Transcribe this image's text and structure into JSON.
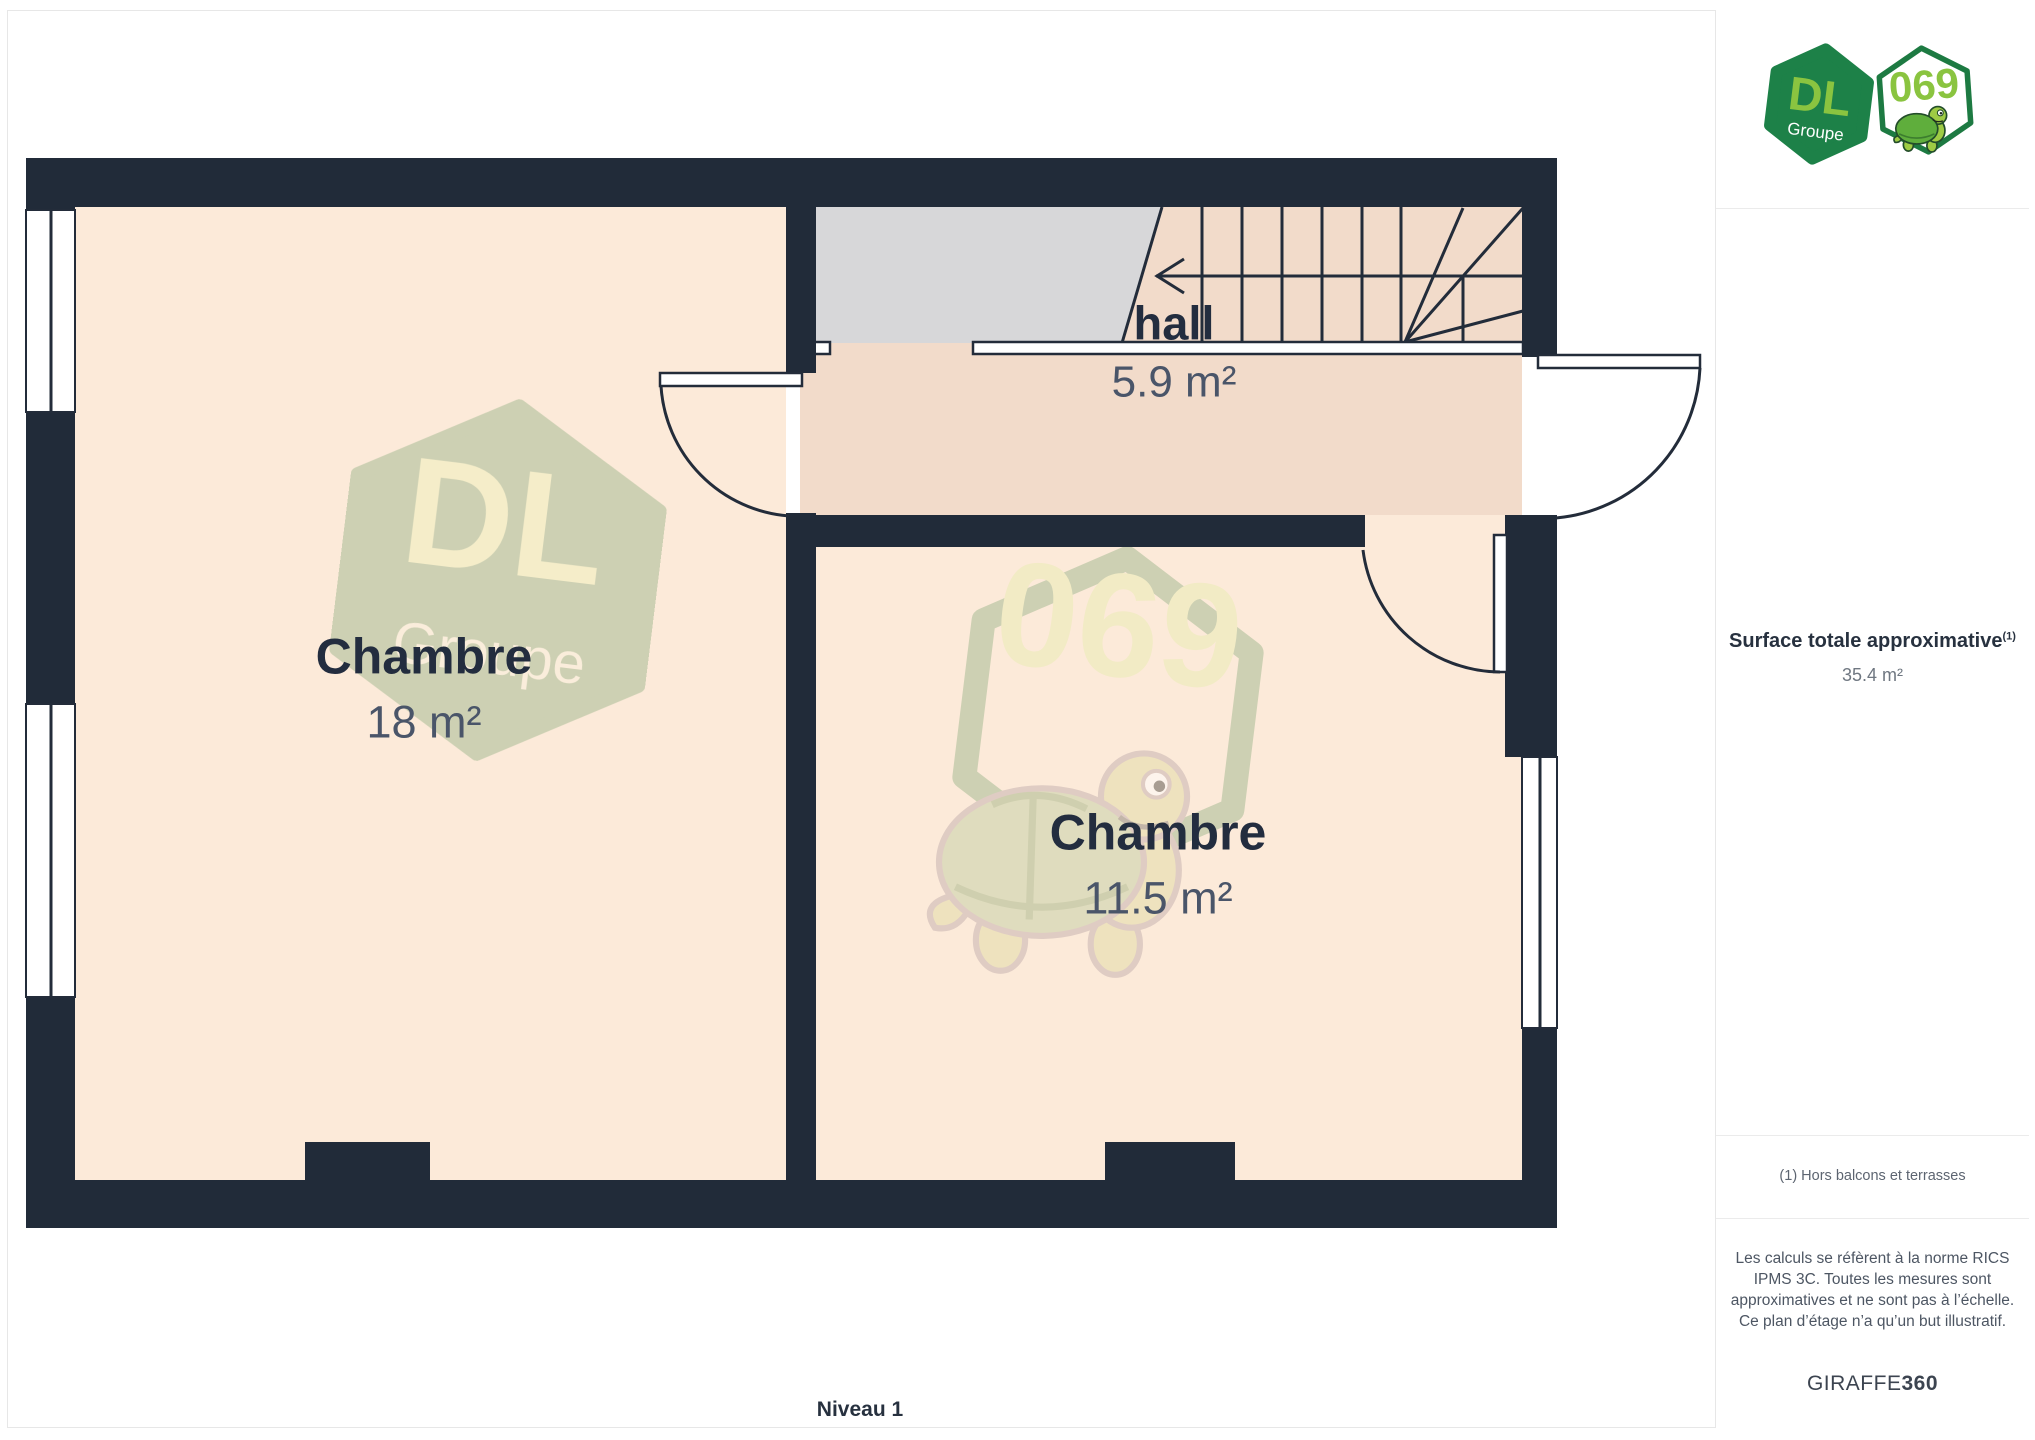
{
  "plan": {
    "level_label": "Niveau 1",
    "rooms": [
      {
        "name": "Chambre",
        "area": "18 m²"
      },
      {
        "name": "hall",
        "area": "5.9 m²"
      },
      {
        "name": "Chambre",
        "area": "11.5 m²"
      }
    ],
    "watermark": {
      "dl": "DL",
      "groupe": "Groupe",
      "number": "069"
    }
  },
  "branding": {
    "logo": {
      "dl": "DL",
      "groupe": "Groupe",
      "number": "069"
    }
  },
  "sidebar": {
    "surface": {
      "label": "Surface totale approximative",
      "note_ref": "(1)",
      "value": "35.4 m²"
    },
    "footnote": "(1) Hors balcons et terrasses",
    "disclaimer": "Les calculs se réfèrent à la norme RICS IPMS 3C. Toutes les mesures sont approximatives et ne sont pas à l’échelle. Ce plan d’étage n’a qu’un but illustratif.",
    "brand": {
      "name": "GIRAFFE",
      "suffix": "360"
    }
  },
  "colors": {
    "wall": "#212b39",
    "room_fill": "#fcead9",
    "hall_fill": "#f2dbca",
    "stair_gray": "#d7d7d9",
    "brand_green": "#1d8148",
    "brand_lime": "#8ac440",
    "label_dark": "#232d3f",
    "label_gray": "#4a5569",
    "watermark_sage": "#9eb78d"
  }
}
